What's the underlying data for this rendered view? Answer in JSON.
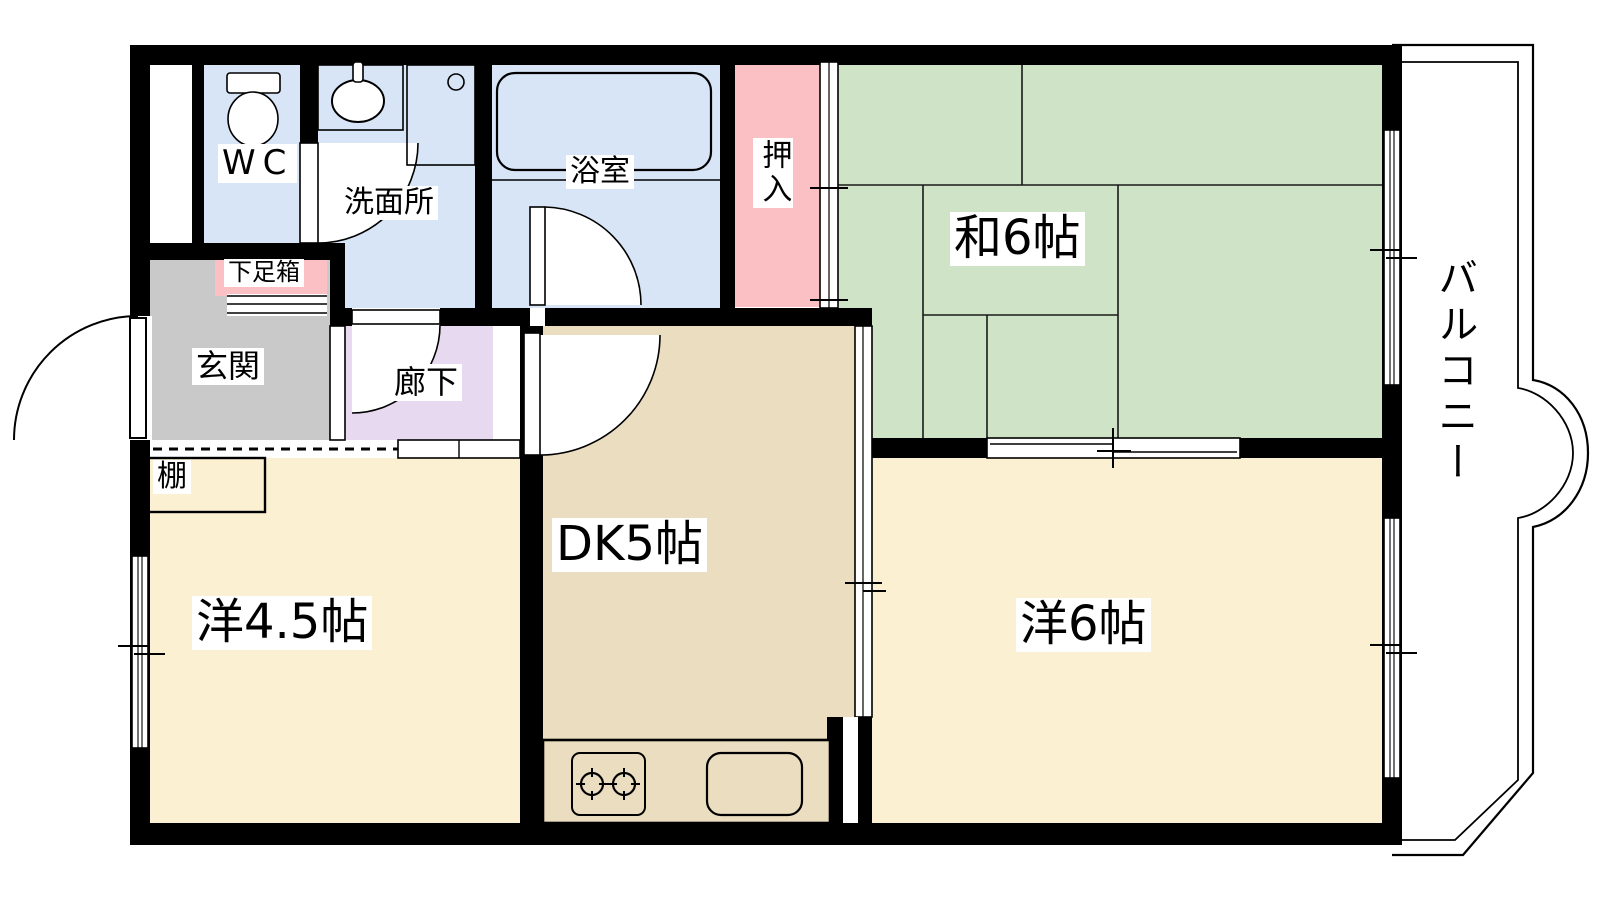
{
  "floorplan": {
    "labels": {
      "wc": "WC",
      "washroom": "洗面所",
      "bathroom": "浴室",
      "closet": "押入",
      "japanese_room": "和6帖",
      "shoe_cabinet": "下足箱",
      "entrance": "玄関",
      "hallway": "廊下",
      "shelf": "棚",
      "western_room_4_5": "洋4.5帖",
      "dining_kitchen": "DK5帖",
      "western_room_6": "洋6帖",
      "balcony": "バルコニー"
    },
    "colors": {
      "water_rooms": "#D7E5F6",
      "closet": "#FBC0C3",
      "tatami": "#CFE3C6",
      "entrance": "#C9C9C9",
      "hallway": "#E7D9F0",
      "western_rooms": "#FCF0D2",
      "dining_kitchen": "#EBDDBF",
      "walls": "#000000",
      "background": "#FFFFFF"
    }
  }
}
